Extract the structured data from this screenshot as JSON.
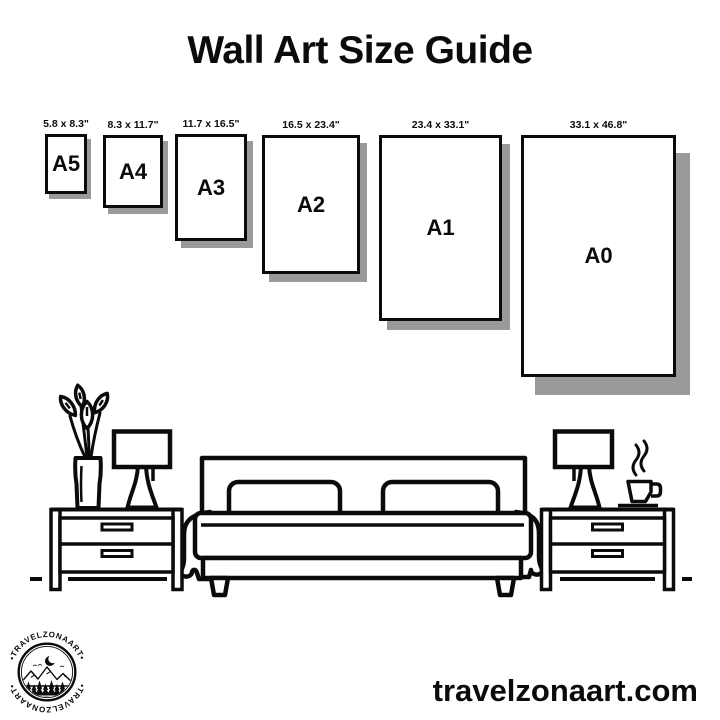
{
  "page": {
    "title": "Wall Art Size Guide",
    "website": "travelzonaart.com",
    "colors": {
      "ink": "#0b0b0b",
      "background": "#ffffff",
      "shadow": "#9a9a9a"
    }
  },
  "size_guide": {
    "sizes": [
      {
        "name": "A5",
        "dimensions": "5.8 x 8.3\"",
        "x": 45,
        "y": 134,
        "w": 42,
        "h": 60,
        "shadow_x": 4,
        "shadow_y": 5
      },
      {
        "name": "A4",
        "dimensions": "8.3 x 11.7\"",
        "x": 103,
        "y": 135,
        "w": 60,
        "h": 73,
        "shadow_x": 5,
        "shadow_y": 6
      },
      {
        "name": "A3",
        "dimensions": "11.7 x 16.5\"",
        "x": 175,
        "y": 134,
        "w": 72,
        "h": 107,
        "shadow_x": 6,
        "shadow_y": 7
      },
      {
        "name": "A2",
        "dimensions": "16.5 x 23.4\"",
        "x": 262,
        "y": 135,
        "w": 98,
        "h": 139,
        "shadow_x": 7,
        "shadow_y": 8
      },
      {
        "name": "A1",
        "dimensions": "23.4 x 33.1\"",
        "x": 379,
        "y": 135,
        "w": 123,
        "h": 186,
        "shadow_x": 8,
        "shadow_y": 9
      },
      {
        "name": "A0",
        "dimensions": "33.1 x 46.8\"",
        "x": 521,
        "y": 135,
        "w": 155,
        "h": 242,
        "shadow_x": 14,
        "shadow_y": 18
      }
    ]
  },
  "logo": {
    "arc_text_top": "•TRAVELZONAART•",
    "arc_text_bottom": "•TRAVELZONAART•"
  }
}
